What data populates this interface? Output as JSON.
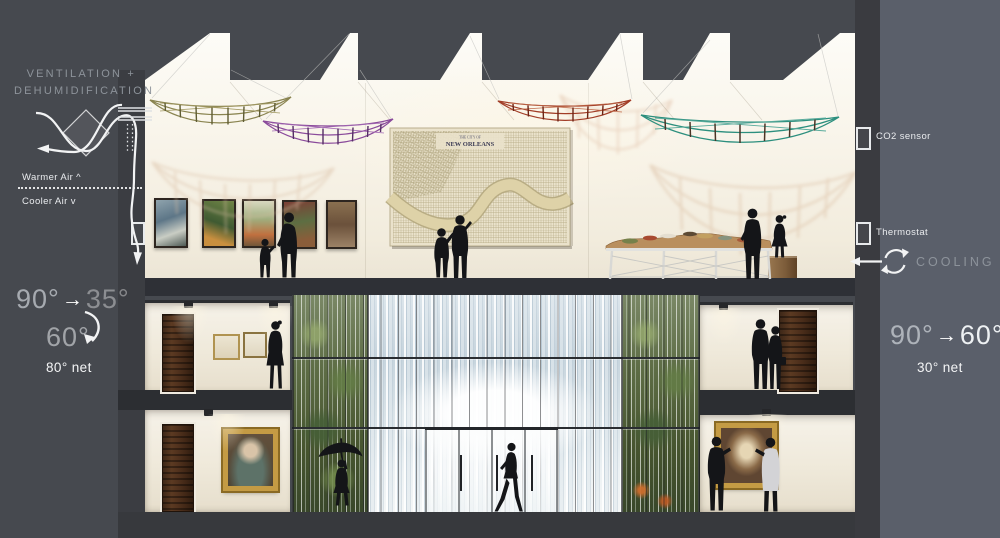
{
  "annotations": {
    "ventilation": {
      "line1": "VENTILATION +",
      "line2": "DEHUMIDIFICATION"
    },
    "warmer_air": "Warmer Air ^",
    "cooler_air": "Cooler Air v",
    "left_temps": {
      "from": "90°",
      "arrow": "→",
      "to": "35°",
      "mixed": "60°",
      "net": "80° net"
    },
    "right_temps": {
      "from": "90°",
      "arrow": "→",
      "to": "60°",
      "net": "30° net"
    },
    "co2_sensor": "CO2 sensor",
    "thermostat": "Thermostat",
    "cooling": "COOLING"
  },
  "map": {
    "title_line1": "THE CITY OF",
    "title_line2": "NEW ORLEANS"
  },
  "palette": {
    "background_left": "#46494f",
    "background_right": "#5a5f6a",
    "panel_dark": "#3a3c41",
    "slab": "#2e3036",
    "wall_cream": "#f6f2e8",
    "silhouette": "#141518",
    "boat_olive": "#8a8450",
    "boat_purple": "#8a4a9b",
    "boat_rust": "#a23d27",
    "boat_teal": "#2c8f7e",
    "frame_gold": "#c49b44",
    "door_wood": "#4a2d1a",
    "waterfall": "#d8e2e7",
    "vegetation": "#5d6c45"
  }
}
